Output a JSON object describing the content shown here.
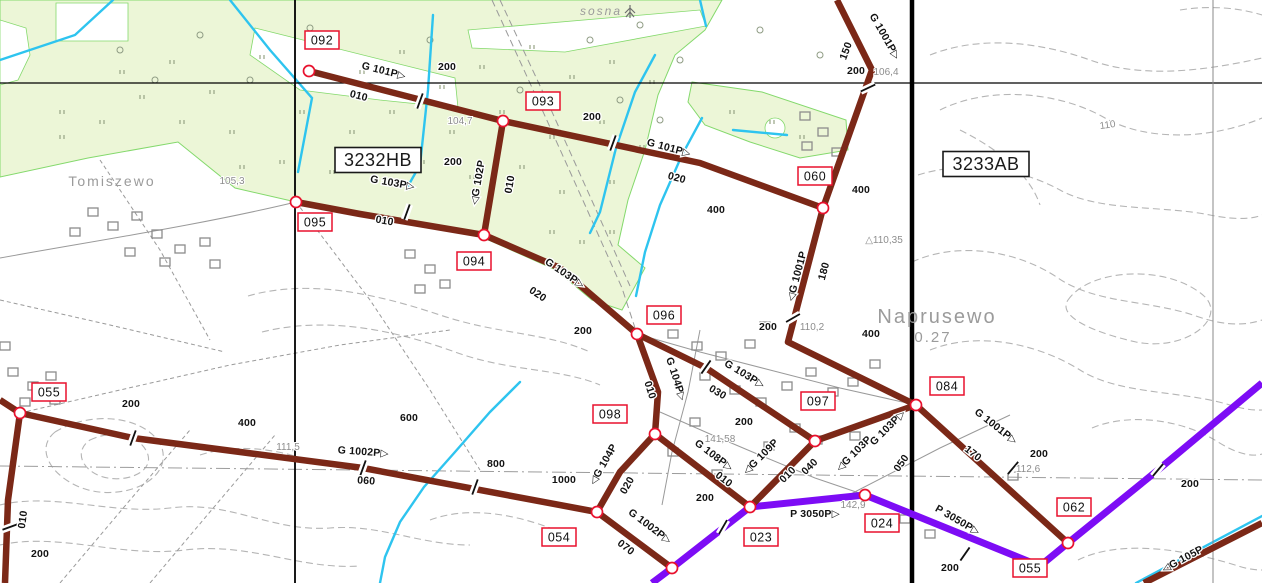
{
  "map": {
    "colors": {
      "pipe_brown": "#7b2817",
      "pipe_purple": "#7d0cf5",
      "stream_cyan": "#2ec4ef",
      "forest_fill": "#ecf6d7",
      "forest_edge": "#84d96c",
      "node_red": "#e8112d",
      "grid_black": "#000000",
      "topo_gray": "#9a9a9a",
      "contour_gray": "#b5b5b5"
    },
    "sheet_labels": [
      {
        "text": "3232HB",
        "x": 378,
        "y": 160
      },
      {
        "text": "3233AB",
        "x": 986,
        "y": 164
      }
    ],
    "place_names": [
      {
        "text": "Tomiszewo",
        "x": 112,
        "y": 186,
        "size": 14,
        "spacing": 2
      },
      {
        "text": "Naprusewo",
        "x": 937,
        "y": 323,
        "size": 20,
        "spacing": 3
      },
      {
        "text": "0.27",
        "x": 933,
        "y": 342,
        "size": 15,
        "spacing": 1
      },
      {
        "text": "sosna",
        "x": 601,
        "y": 15,
        "size": 12,
        "spacing": 0
      }
    ],
    "elevations": [
      {
        "text": "105,3",
        "x": 232,
        "y": 184,
        "rot": 0
      },
      {
        "text": "104,7",
        "x": 460,
        "y": 124,
        "rot": 0
      },
      {
        "text": "106,4",
        "x": 886,
        "y": 75,
        "rot": 0
      },
      {
        "text": "110",
        "x": 1108,
        "y": 128,
        "rot": -8
      },
      {
        "text": "△110,35",
        "x": 884,
        "y": 243,
        "rot": 0
      },
      {
        "text": "110,2",
        "x": 812,
        "y": 330,
        "rot": 0
      },
      {
        "text": "112,6",
        "x": 1028,
        "y": 472,
        "rot": 0
      },
      {
        "text": "111,5",
        "x": 288,
        "y": 450,
        "rot": 0
      },
      {
        "text": "141,58",
        "x": 720,
        "y": 442,
        "rot": 0
      },
      {
        "text": "142,9",
        "x": 853,
        "y": 508,
        "rot": 0
      }
    ],
    "pipe_labels": [
      {
        "text": "G 101P▷",
        "x": 383,
        "y": 74,
        "rot": 14
      },
      {
        "text": "010",
        "x": 358,
        "y": 99,
        "rot": 14
      },
      {
        "text": "200",
        "x": 447,
        "y": 70,
        "rot": 0
      },
      {
        "text": "200",
        "x": 592,
        "y": 120,
        "rot": 0
      },
      {
        "text": "G 101P▷",
        "x": 668,
        "y": 151,
        "rot": 15
      },
      {
        "text": "020",
        "x": 676,
        "y": 181,
        "rot": 15
      },
      {
        "text": "400",
        "x": 716,
        "y": 213,
        "rot": 0
      },
      {
        "text": "G 1001P▷",
        "x": 882,
        "y": 38,
        "rot": 60
      },
      {
        "text": "150",
        "x": 849,
        "y": 52,
        "rot": -70
      },
      {
        "text": "200",
        "x": 856,
        "y": 74,
        "rot": 0
      },
      {
        "text": "400",
        "x": 861,
        "y": 193,
        "rot": 0
      },
      {
        "text": "◁G 1001P",
        "x": 800,
        "y": 277,
        "rot": -75
      },
      {
        "text": "180",
        "x": 827,
        "y": 272,
        "rot": -75
      },
      {
        "text": "200",
        "x": 768,
        "y": 330,
        "rot": 0
      },
      {
        "text": "400",
        "x": 871,
        "y": 337,
        "rot": 0
      },
      {
        "text": "◁G 102P",
        "x": 481,
        "y": 183,
        "rot": -80
      },
      {
        "text": "010",
        "x": 513,
        "y": 185,
        "rot": -80
      },
      {
        "text": "200",
        "x": 453,
        "y": 165,
        "rot": 0
      },
      {
        "text": "G 103P▷",
        "x": 392,
        "y": 186,
        "rot": 10
      },
      {
        "text": "010",
        "x": 384,
        "y": 224,
        "rot": 10
      },
      {
        "text": "G 103P▷",
        "x": 563,
        "y": 276,
        "rot": 34
      },
      {
        "text": "020",
        "x": 536,
        "y": 297,
        "rot": 34
      },
      {
        "text": "200",
        "x": 583,
        "y": 334,
        "rot": 0
      },
      {
        "text": "G 103P▷",
        "x": 743,
        "y": 377,
        "rot": 31
      },
      {
        "text": "030",
        "x": 716,
        "y": 395,
        "rot": 31
      },
      {
        "text": "200",
        "x": 744,
        "y": 425,
        "rot": 0
      },
      {
        "text": "◁G 103P",
        "x": 856,
        "y": 456,
        "rot": -45
      },
      {
        "text": "G 103P▷",
        "x": 890,
        "y": 430,
        "rot": -45
      },
      {
        "text": "050",
        "x": 904,
        "y": 465,
        "rot": -55
      },
      {
        "text": "G 1001P▷",
        "x": 994,
        "y": 429,
        "rot": 38
      },
      {
        "text": "170",
        "x": 971,
        "y": 456,
        "rot": 38
      },
      {
        "text": "200",
        "x": 1039,
        "y": 457,
        "rot": 0
      },
      {
        "text": "G 104P▷",
        "x": 673,
        "y": 380,
        "rot": 72
      },
      {
        "text": "010",
        "x": 647,
        "y": 391,
        "rot": 72
      },
      {
        "text": "◁G 104P",
        "x": 606,
        "y": 466,
        "rot": -60
      },
      {
        "text": "020",
        "x": 630,
        "y": 487,
        "rot": -60
      },
      {
        "text": "G 108P▷",
        "x": 712,
        "y": 458,
        "rot": 37
      },
      {
        "text": "010",
        "x": 722,
        "y": 482,
        "rot": 37
      },
      {
        "text": "200",
        "x": 705,
        "y": 501,
        "rot": 0
      },
      {
        "text": "◁G 109P",
        "x": 763,
        "y": 459,
        "rot": -45
      },
      {
        "text": "010",
        "x": 790,
        "y": 477,
        "rot": -45
      },
      {
        "text": "040",
        "x": 812,
        "y": 469,
        "rot": -45
      },
      {
        "text": "200",
        "x": 131,
        "y": 407,
        "rot": 0
      },
      {
        "text": "400",
        "x": 247,
        "y": 426,
        "rot": 0
      },
      {
        "text": "600",
        "x": 409,
        "y": 421,
        "rot": 0
      },
      {
        "text": "800",
        "x": 496,
        "y": 467,
        "rot": 0
      },
      {
        "text": "1000",
        "x": 564,
        "y": 483,
        "rot": 0
      },
      {
        "text": "G 1002P▷",
        "x": 363,
        "y": 455,
        "rot": 4
      },
      {
        "text": "060",
        "x": 366,
        "y": 484,
        "rot": 4
      },
      {
        "text": "G 1002P▷",
        "x": 648,
        "y": 529,
        "rot": 37
      },
      {
        "text": "070",
        "x": 624,
        "y": 550,
        "rot": 37
      },
      {
        "text": "010",
        "x": 26,
        "y": 520,
        "rot": -82
      },
      {
        "text": "200",
        "x": 40,
        "y": 557,
        "rot": 0
      },
      {
        "text": "P 3050P▷",
        "x": 815,
        "y": 517,
        "rot": 0
      },
      {
        "text": "P 3050P▷",
        "x": 956,
        "y": 523,
        "rot": 30
      },
      {
        "text": "200",
        "x": 950,
        "y": 571,
        "rot": 0
      },
      {
        "text": "200",
        "x": 1190,
        "y": 487,
        "rot": 0
      },
      {
        "text": "◁G 105P",
        "x": 1184,
        "y": 562,
        "rot": -28
      }
    ],
    "node_labels": [
      {
        "id": "092",
        "x": 322,
        "y": 40
      },
      {
        "id": "093",
        "x": 543,
        "y": 101
      },
      {
        "id": "095",
        "x": 315,
        "y": 222
      },
      {
        "id": "094",
        "x": 474,
        "y": 261
      },
      {
        "id": "060",
        "x": 815,
        "y": 176
      },
      {
        "id": "096",
        "x": 664,
        "y": 315
      },
      {
        "id": "098",
        "x": 610,
        "y": 414
      },
      {
        "id": "097",
        "x": 818,
        "y": 401
      },
      {
        "id": "084",
        "x": 947,
        "y": 386
      },
      {
        "id": "055",
        "x": 49,
        "y": 392
      },
      {
        "id": "054",
        "x": 559,
        "y": 537
      },
      {
        "id": "023",
        "x": 761,
        "y": 537
      },
      {
        "id": "024",
        "x": 882,
        "y": 523
      },
      {
        "id": "062",
        "x": 1074,
        "y": 507
      },
      {
        "id": "055",
        "x": 1030,
        "y": 568
      }
    ],
    "nodes": [
      {
        "id": "092",
        "x": 309,
        "y": 71
      },
      {
        "id": "093",
        "x": 503,
        "y": 121
      },
      {
        "id": "095",
        "x": 296,
        "y": 202
      },
      {
        "id": "094",
        "x": 484,
        "y": 235
      },
      {
        "id": "060",
        "x": 823,
        "y": 208
      },
      {
        "id": "096",
        "x": 637,
        "y": 334
      },
      {
        "id": "098",
        "x": 655,
        "y": 434
      },
      {
        "id": "097",
        "x": 815,
        "y": 441
      },
      {
        "id": "084",
        "x": 916,
        "y": 405
      },
      {
        "id": "055",
        "x": 20,
        "y": 413
      },
      {
        "id": "054",
        "x": 597,
        "y": 512
      },
      {
        "id": "023",
        "x": 750,
        "y": 507
      },
      {
        "id": "024",
        "x": 865,
        "y": 495
      },
      {
        "id": "062",
        "x": 1068,
        "y": 543
      },
      {
        "id": "junction-south",
        "x": 672,
        "y": 568
      }
    ],
    "pipelines": [
      {
        "name": "G 101P",
        "kind": "brown",
        "points": [
          [
            309,
            71
          ],
          [
            503,
            121
          ],
          [
            700,
            163
          ],
          [
            823,
            208
          ]
        ]
      },
      {
        "name": "G 1001P",
        "kind": "brown",
        "points": [
          [
            837,
            0
          ],
          [
            872,
            70
          ],
          [
            823,
            208
          ],
          [
            788,
            342
          ],
          [
            916,
            405
          ],
          [
            1068,
            543
          ]
        ]
      },
      {
        "name": "G 102P",
        "kind": "brown",
        "points": [
          [
            503,
            121
          ],
          [
            484,
            235
          ]
        ]
      },
      {
        "name": "G 103P",
        "kind": "brown",
        "points": [
          [
            296,
            202
          ],
          [
            360,
            214
          ],
          [
            484,
            235
          ],
          [
            560,
            268
          ],
          [
            637,
            334
          ],
          [
            706,
            368
          ],
          [
            815,
            441
          ],
          [
            916,
            405
          ]
        ]
      },
      {
        "name": "G 104P",
        "kind": "brown",
        "points": [
          [
            637,
            334
          ],
          [
            658,
            392
          ],
          [
            655,
            434
          ],
          [
            620,
            472
          ],
          [
            597,
            512
          ]
        ]
      },
      {
        "name": "G 108P",
        "kind": "brown",
        "points": [
          [
            655,
            434
          ],
          [
            750,
            507
          ]
        ]
      },
      {
        "name": "G 109P",
        "kind": "brown",
        "points": [
          [
            815,
            441
          ],
          [
            750,
            507
          ]
        ]
      },
      {
        "name": "G 1002P",
        "kind": "brown",
        "points": [
          [
            0,
            400
          ],
          [
            20,
            413
          ],
          [
            133,
            438
          ],
          [
            363,
            468
          ],
          [
            597,
            512
          ],
          [
            672,
            568
          ]
        ]
      },
      {
        "name": "branch-055-south",
        "kind": "brown",
        "points": [
          [
            20,
            413
          ],
          [
            8,
            500
          ],
          [
            5,
            583
          ]
        ]
      },
      {
        "name": "G 105P",
        "kind": "brown",
        "points": [
          [
            1144,
            583
          ],
          [
            1262,
            523
          ]
        ]
      },
      {
        "name": "P 3050P",
        "kind": "purple",
        "points": [
          [
            652,
            583
          ],
          [
            672,
            568
          ],
          [
            750,
            507
          ],
          [
            865,
            495
          ],
          [
            1040,
            566
          ],
          [
            1068,
            543
          ],
          [
            1158,
            470
          ],
          [
            1262,
            383
          ]
        ]
      }
    ],
    "ticks": [
      {
        "x": 420,
        "y": 101,
        "rot": -70
      },
      {
        "x": 613,
        "y": 143,
        "rot": -70
      },
      {
        "x": 868,
        "y": 88,
        "rot": -25
      },
      {
        "x": 793,
        "y": 318,
        "rot": -30
      },
      {
        "x": 706,
        "y": 367,
        "rot": -55
      },
      {
        "x": 407,
        "y": 212,
        "rot": -70
      },
      {
        "x": 1013,
        "y": 468,
        "rot": -50
      },
      {
        "x": 133,
        "y": 438,
        "rot": -70
      },
      {
        "x": 363,
        "y": 468,
        "rot": -70
      },
      {
        "x": 475,
        "y": 487,
        "rot": -70
      },
      {
        "x": 10,
        "y": 527,
        "rot": -20
      },
      {
        "x": 965,
        "y": 554,
        "rot": -55
      },
      {
        "x": 1158,
        "y": 470,
        "rot": -50
      },
      {
        "x": 723,
        "y": 527,
        "rot": -60
      }
    ],
    "streams": [
      [
        [
          113,
          0
        ],
        [
          75,
          35
        ],
        [
          0,
          60
        ]
      ],
      [
        [
          230,
          0
        ],
        [
          270,
          50
        ],
        [
          312,
          98
        ],
        [
          298,
          172
        ]
      ],
      [
        [
          433,
          15
        ],
        [
          428,
          90
        ],
        [
          420,
          165
        ],
        [
          408,
          186
        ]
      ],
      [
        [
          655,
          55
        ],
        [
          635,
          92
        ],
        [
          616,
          148
        ],
        [
          600,
          212
        ],
        [
          590,
          233
        ]
      ],
      [
        [
          700,
          0
        ],
        [
          706,
          26
        ]
      ],
      [
        [
          702,
          118
        ],
        [
          682,
          155
        ],
        [
          660,
          205
        ],
        [
          645,
          252
        ],
        [
          636,
          296
        ]
      ],
      [
        [
          520,
          382
        ],
        [
          490,
          412
        ],
        [
          455,
          452
        ],
        [
          424,
          487
        ],
        [
          400,
          522
        ],
        [
          385,
          557
        ],
        [
          380,
          583
        ]
      ],
      [
        [
          1136,
          583
        ],
        [
          1262,
          516
        ]
      ],
      [
        [
          733,
          130
        ],
        [
          787,
          135
        ]
      ]
    ],
    "forest": [
      [
        [
          0,
          0
        ],
        [
          722,
          0
        ],
        [
          705,
          30
        ],
        [
          675,
          55
        ],
        [
          658,
          95
        ],
        [
          645,
          150
        ],
        [
          628,
          200
        ],
        [
          618,
          245
        ],
        [
          645,
          268
        ],
        [
          622,
          310
        ],
        [
          592,
          300
        ],
        [
          556,
          270
        ],
        [
          484,
          238
        ],
        [
          420,
          222
        ],
        [
          350,
          210
        ],
        [
          296,
          202
        ],
        [
          235,
          188
        ],
        [
          178,
          142
        ],
        [
          88,
          158
        ],
        [
          0,
          177
        ]
      ],
      [
        [
          692,
          82
        ],
        [
          762,
          92
        ],
        [
          846,
          120
        ],
        [
          848,
          150
        ],
        [
          800,
          158
        ],
        [
          750,
          142
        ],
        [
          705,
          125
        ],
        [
          688,
          102
        ]
      ]
    ],
    "clearings": [
      [
        [
          56,
          3
        ],
        [
          128,
          3
        ],
        [
          128,
          41
        ],
        [
          56,
          41
        ]
      ],
      [
        [
          0,
          20
        ],
        [
          26,
          28
        ],
        [
          30,
          55
        ],
        [
          18,
          80
        ],
        [
          0,
          85
        ]
      ],
      [
        [
          468,
          30
        ],
        [
          700,
          10
        ],
        [
          706,
          26
        ],
        [
          565,
          52
        ],
        [
          472,
          48
        ]
      ],
      [
        [
          255,
          28
        ],
        [
          455,
          78
        ],
        [
          458,
          108
        ],
        [
          380,
          100
        ],
        [
          300,
          90
        ],
        [
          250,
          55
        ]
      ]
    ],
    "grid_lines": [
      {
        "x1": 0,
        "y1": 83,
        "x2": 1262,
        "y2": 83,
        "w": 1.2,
        "color": "#000000"
      },
      {
        "x1": 295,
        "y1": 0,
        "x2": 295,
        "y2": 583,
        "w": 1.8,
        "color": "#000000"
      },
      {
        "x1": 912,
        "y1": 0,
        "x2": 912,
        "y2": 583,
        "w": 4.5,
        "color": "#000000"
      },
      {
        "x1": 1213,
        "y1": 0,
        "x2": 1213,
        "y2": 583,
        "w": 1,
        "color": "#8a8a8a"
      }
    ]
  }
}
